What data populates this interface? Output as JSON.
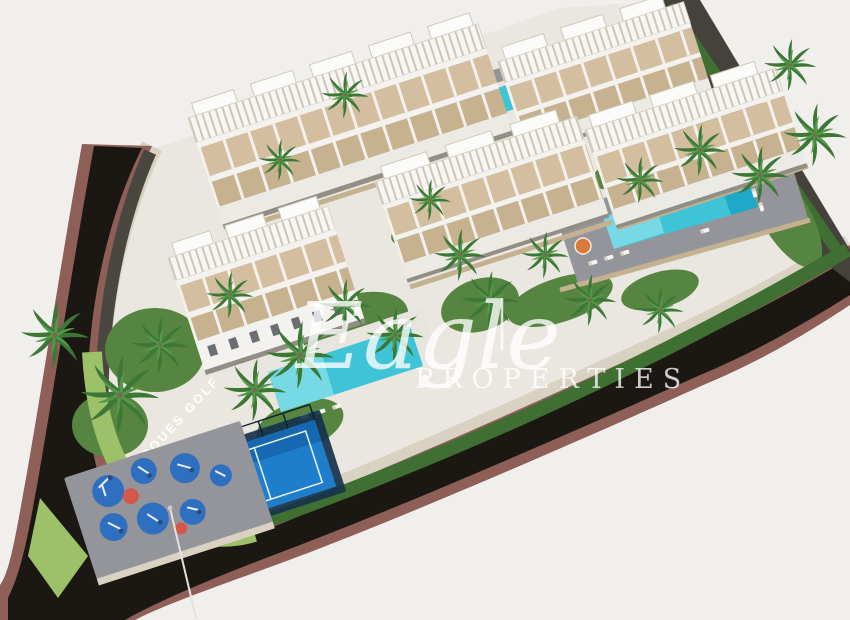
{
  "watermark": {
    "brand_script": "Eagle",
    "brand_caps": "PROPERTIES"
  },
  "labels": {
    "road_label": "MARQUES GOLF"
  },
  "colors": {
    "bg": "#f1efec",
    "road": "#1b1713",
    "sidewalk": "#8d5f57",
    "wall": "#d9d2c3",
    "darkwall": "#45413b",
    "rock": "#4a4741",
    "grass": "#568441",
    "grasslight": "#9cc169",
    "hedge": "#3f6f33",
    "concrete": "#eae7e1",
    "paving": "#94959a",
    "water": "#3ec4d6",
    "waterlight": "#8fe3ea",
    "waterdeep": "#18a3c4",
    "deck": "#e8e5df",
    "building": "#f3f2ef",
    "terrace": "#d3bf9f",
    "terracedark": "#c7b28f",
    "shadow": "#938e85",
    "padel": "#1f7ecb",
    "padelframe": "#16324b",
    "pad": "#2f6fc0",
    "padred": "#d4584a",
    "palm": "#3c7736",
    "palmlight": "#54994a",
    "trunk": "#7b6b4e",
    "label": "#ffffff",
    "wm": "rgba(255,255,255,0.78)"
  }
}
